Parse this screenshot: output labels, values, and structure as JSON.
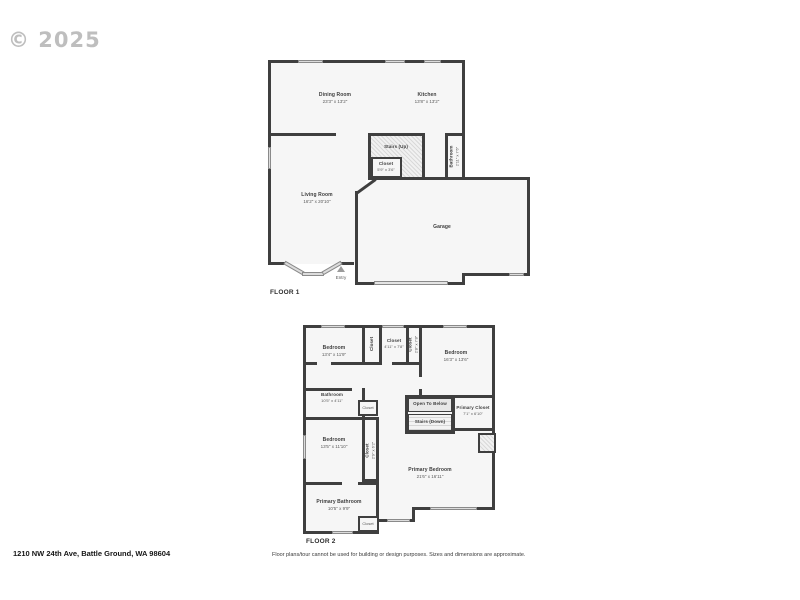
{
  "watermark": "© 2025",
  "colors": {
    "wall": "#3f3f3f",
    "room_fill": "#f6f6f6",
    "window": "#dcdcdc",
    "watermark": "#aeaeae"
  },
  "footer": {
    "address": "1210 NW 24th Ave, Battle Ground, WA 98604",
    "disclaimer": "Floor plans/tour cannot be used for building or design purposes. Sizes and dimensions are approximate."
  },
  "floor1": {
    "label": "FLOOR 1",
    "rooms": {
      "dining": {
        "name": "Dining Room",
        "dims": "23'3\" x 13'2\""
      },
      "kitchen": {
        "name": "Kitchen",
        "dims": "13'8\" x 13'2\""
      },
      "stairs": {
        "name": "Stairs (Up)"
      },
      "closet": {
        "name": "Closet",
        "dims": "5'9\" x 3'6\""
      },
      "bathroom": {
        "name": "Bathroom",
        "dims": "2'11\" x 7'6\""
      },
      "living": {
        "name": "Living Room",
        "dims": "16'2\" x 20'10\""
      },
      "garage": {
        "name": "Garage"
      },
      "entry": {
        "name": "Entry"
      }
    }
  },
  "floor2": {
    "label": "FLOOR 2",
    "rooms": {
      "bedroom_nw": {
        "name": "Bedroom",
        "dims": "13'4\" x 11'9\""
      },
      "closet_w": {
        "name": "Closet"
      },
      "closet_mid": {
        "name": "Closet",
        "dims": "4'11\" x 7'8\""
      },
      "closet_e": {
        "name": "Closet",
        "dims": "2'8\" x 7'8\""
      },
      "bedroom_ne": {
        "name": "Bedroom",
        "dims": "16'3\" x 13'6\""
      },
      "bathroom": {
        "name": "Bathroom",
        "dims": "10'5\" x 4'11\""
      },
      "closet_hall": {
        "name": "Closet"
      },
      "open_below": {
        "name": "Open To Below"
      },
      "stairs": {
        "name": "Stairs (Down)"
      },
      "primary_closet": {
        "name": "Primary Closet",
        "dims": "7'1\" x 6'10\""
      },
      "bedroom_sw": {
        "name": "Bedroom",
        "dims": "13'5\" x 11'10\""
      },
      "closet_sw": {
        "name": "Closet",
        "dims": "2'9\" x 6'2\""
      },
      "primary_bedroom": {
        "name": "Primary Bedroom",
        "dims": "21'6\" x 16'11\""
      },
      "primary_bathroom": {
        "name": "Primary Bathroom",
        "dims": "10'5\" x 9'9\""
      },
      "closet_s": {
        "name": "Closet"
      }
    }
  }
}
